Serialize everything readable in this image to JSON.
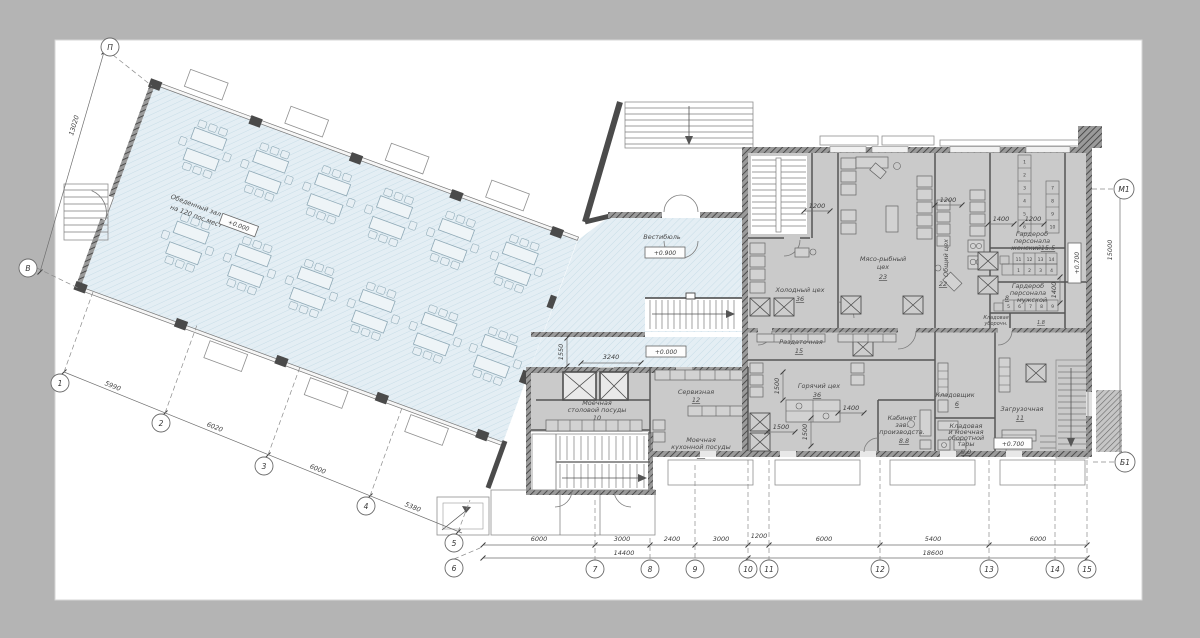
{
  "canvas": {
    "background": "#b4b4b4",
    "paper": "#ffffff"
  },
  "colors": {
    "hall_fill": "#e4eef4",
    "hall_hatch": "#c5dbe6",
    "block_fill": "#cacaca",
    "wall": "#4b4b4b",
    "line": "#6e6e6e",
    "text": "#444444"
  },
  "rooms": {
    "dining": {
      "name": "Обеденный зал",
      "name2": "на 120 пос.мест"
    },
    "vestibule": {
      "name": "Вестибюль"
    },
    "cold": {
      "name": "Холодный цех",
      "num": "36"
    },
    "meat": {
      "name": "Мясо-рыбный",
      "name2": "цех",
      "num": "23"
    },
    "common": {
      "name": "Общий цех",
      "num": "22"
    },
    "ww": {
      "name": "Гардероб",
      "name2": "персонала",
      "name3": "женский",
      "num": "15.5"
    },
    "wm": {
      "name": "Гардероб",
      "name2": "персонала",
      "name3": "мужской",
      "num": "8"
    },
    "clean": {
      "name": "Кладовая",
      "name2": "уборочн.",
      "num": "1.8"
    },
    "serve": {
      "name": "Раздаточная",
      "num": "15"
    },
    "hot": {
      "name": "Горячий цех",
      "num": "36"
    },
    "keeper": {
      "name": "Кладовщик",
      "num": "6"
    },
    "chief": {
      "name": "Кабинет",
      "name2": "зав.",
      "name3": "производств.",
      "num": "8.8"
    },
    "tare": {
      "name": "Кладовая",
      "name2": "и моечная",
      "name3": "оборотной",
      "name4": "тары",
      "num": "9.0"
    },
    "load": {
      "name": "Загрузочная",
      "num": "11"
    },
    "washT": {
      "name": "Моечная",
      "name2": "столовой посуды",
      "num": "10"
    },
    "serv": {
      "name": "Сервизная",
      "num": "12"
    },
    "washK": {
      "name": "Моечная",
      "name2": "кухонной посуды",
      "num": "11"
    }
  },
  "elevations": {
    "hall": "+0.000",
    "vestibule": "+0.900",
    "lobby_low": "+0.000",
    "loading": "+0.700",
    "wardrobe": "+0.700"
  },
  "lockers": {
    "colA": [
      "1",
      "2",
      "3",
      "4",
      "5",
      "6"
    ],
    "colB": [
      "7",
      "8",
      "9",
      "10"
    ],
    "women_top": [
      "11",
      "12",
      "13",
      "14"
    ],
    "women_bottom": [
      "1",
      "2",
      "3",
      "4"
    ],
    "men": [
      "5",
      "6",
      "7",
      "8",
      "9"
    ]
  },
  "grid": {
    "letters": {
      "top_left": "П",
      "left": "В",
      "right_top": "М1",
      "right_bottom": "Б1"
    },
    "nums": [
      "1",
      "2",
      "3",
      "4",
      "5",
      "6",
      "7",
      "8",
      "9",
      "10",
      "11",
      "12",
      "13",
      "14",
      "15"
    ]
  },
  "dims": {
    "bottom": [
      "6000",
      "3000",
      "2400",
      "3000",
      "1200",
      "6000",
      "5400",
      "6000"
    ],
    "totals": [
      "14400",
      "18600"
    ],
    "diagonal": [
      "5990",
      "6020",
      "6000",
      "5380"
    ],
    "left": "13020",
    "right": "15000",
    "interior": {
      "t1": "1200",
      "t2": "1400",
      "t3": "1200",
      "stair": "1200",
      "k1": "1400",
      "k2": "1500",
      "k3": "1500",
      "k4": "1500",
      "w1": "1400",
      "v1": "1550",
      "v2": "3240"
    }
  }
}
